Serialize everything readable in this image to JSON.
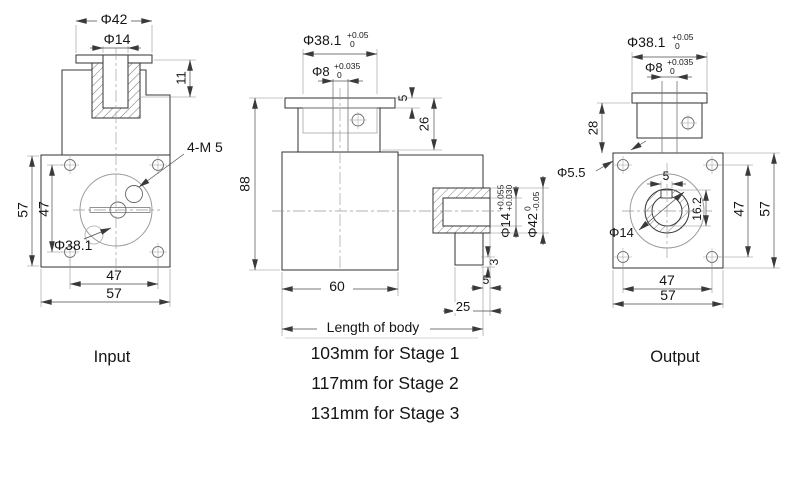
{
  "drawing": {
    "background": "#ffffff",
    "line_color": "#3a3a3a",
    "views": {
      "input": {
        "label": "Input",
        "dia42": "Φ42",
        "dia14": "Φ14",
        "depth11": "11",
        "tap": "4-M 5",
        "dia381": "Φ38.1",
        "side57": "57",
        "side47": "47",
        "bottom47": "47",
        "bottom57": "57"
      },
      "body": {
        "dia381": "Φ38.1",
        "dia381_tol_up": "+0.05",
        "dia381_tol_dn": "0",
        "dia8": "Φ8",
        "dia8_tol_up": "+0.035",
        "dia8_tol_dn": "0",
        "flange5": "5",
        "boss26": "26",
        "height88": "88",
        "width60": "60",
        "dia14": "Φ14",
        "dia14_tol_up": "+0.055",
        "dia14_tol_dn": "+0.030",
        "dia42": "Φ42",
        "dia42_tol_up": "0",
        "dia42_tol_dn": "-0.05",
        "step3": "3",
        "gap5": "5",
        "shaft25": "25",
        "length_label": "Length of body",
        "stages": [
          "103mm for Stage 1",
          "117mm for Stage 2",
          "131mm for Stage 3"
        ]
      },
      "output": {
        "label": "Output",
        "dia381": "Φ38.1",
        "dia381_tol_up": "+0.05",
        "dia381_tol_dn": "0",
        "dia8": "Φ8",
        "dia8_tol_up": "+0.035",
        "dia8_tol_dn": "0",
        "boss28": "28",
        "dia55": "Φ5.5",
        "key5": "5",
        "key162": "16.2",
        "dia14": "Φ14",
        "side47": "47",
        "side57": "57",
        "bottom47": "47",
        "bottom57": "57"
      }
    }
  }
}
